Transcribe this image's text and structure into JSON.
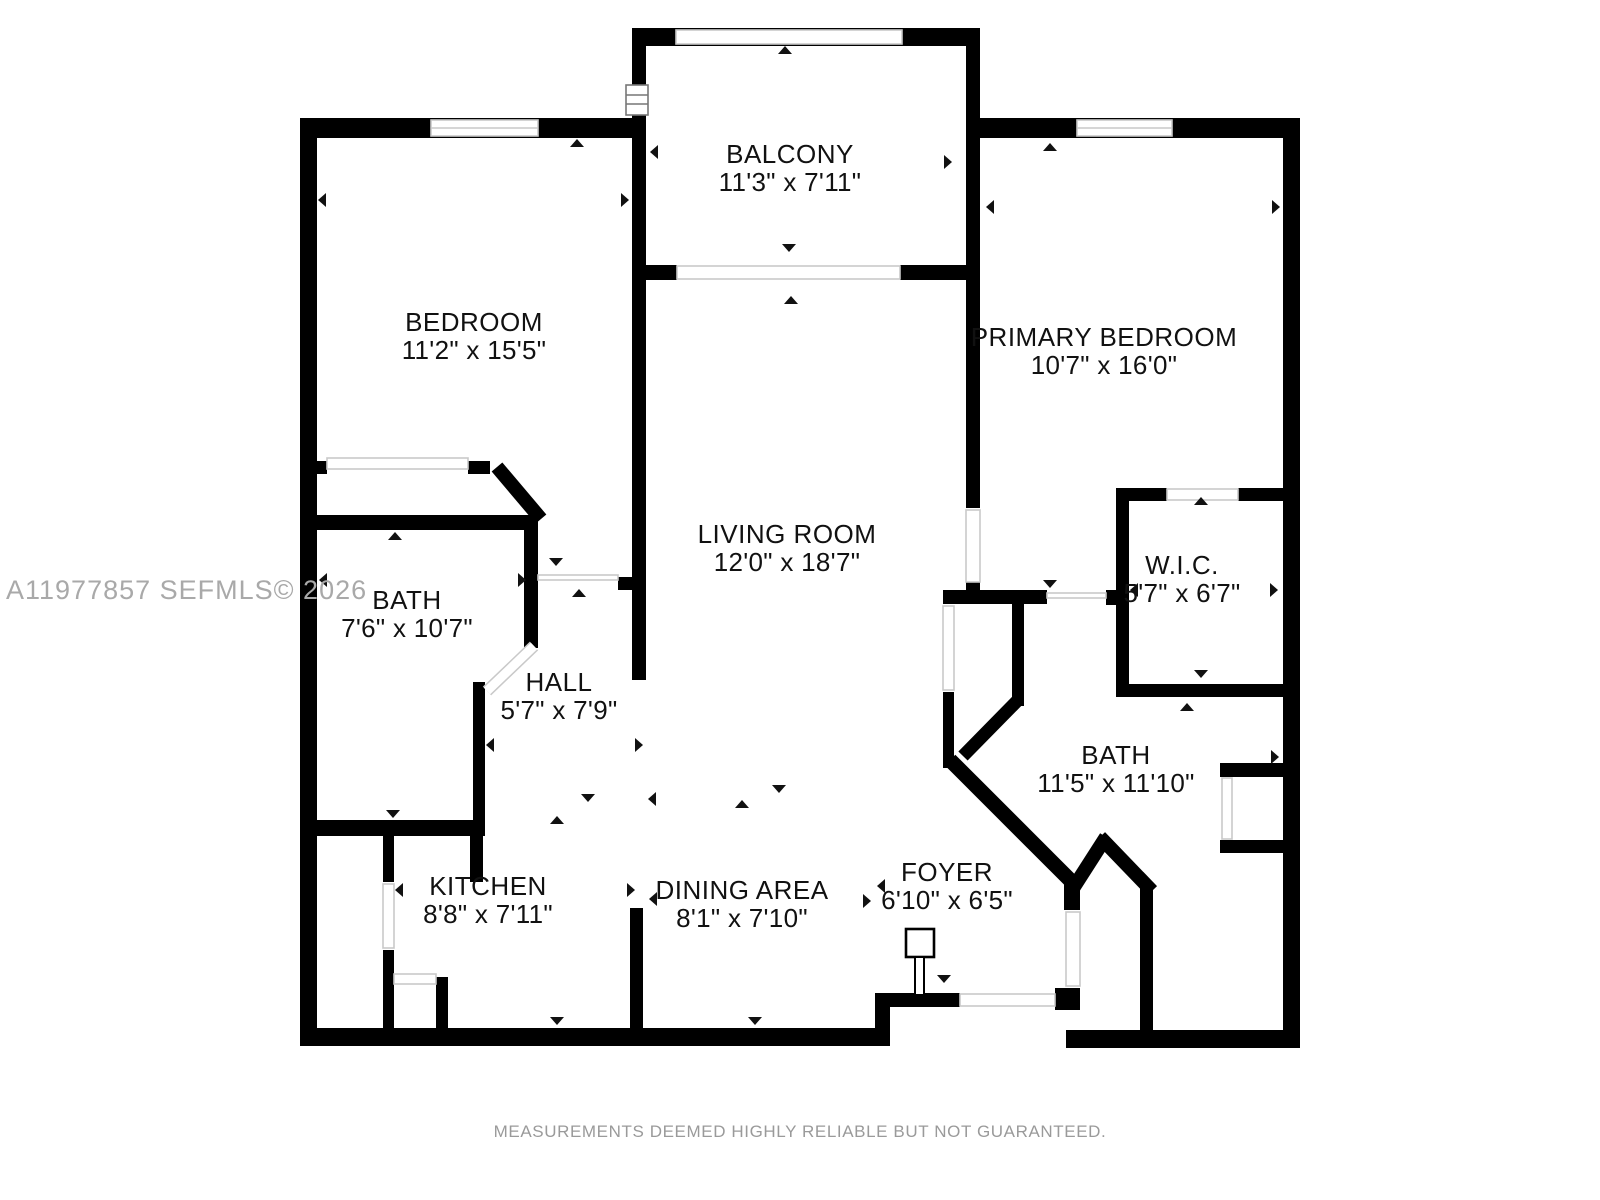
{
  "watermark": "A11977857  SEFMLS© 2026",
  "footer": "MEASUREMENTS DEEMED HIGHLY RELIABLE BUT NOT GUARANTEED.",
  "rooms": {
    "balcony": {
      "name": "BALCONY",
      "dims": "11'3\" x 7'11\""
    },
    "bedroom": {
      "name": "BEDROOM",
      "dims": "11'2\" x 15'5\""
    },
    "primary_bedroom": {
      "name": "PRIMARY BEDROOM",
      "dims": "10'7\" x 16'0\""
    },
    "living_room": {
      "name": "LIVING ROOM",
      "dims": "12'0\" x 18'7\""
    },
    "bath": {
      "name": "BATH",
      "dims": "7'6\" x 10'7\""
    },
    "hall": {
      "name": "HALL",
      "dims": "5'7\" x 7'9\""
    },
    "wic": {
      "name": "W.I.C.",
      "dims": "5'7\" x 6'7\""
    },
    "primary_bath": {
      "name": "BATH",
      "dims": "11'5\" x 11'10\""
    },
    "kitchen": {
      "name": "KITCHEN",
      "dims": "8'8\" x 7'11\""
    },
    "dining_area": {
      "name": "DINING AREA",
      "dims": "8'1\" x 7'10\""
    },
    "foyer": {
      "name": "FOYER",
      "dims": "6'10\" x 6'5\""
    }
  },
  "colors": {
    "walls": "#000000",
    "opening_lines": "#c9c9c9",
    "watermark_text": "#a9a9a9",
    "footer_text": "#9a9a9a",
    "background": "#ffffff"
  }
}
